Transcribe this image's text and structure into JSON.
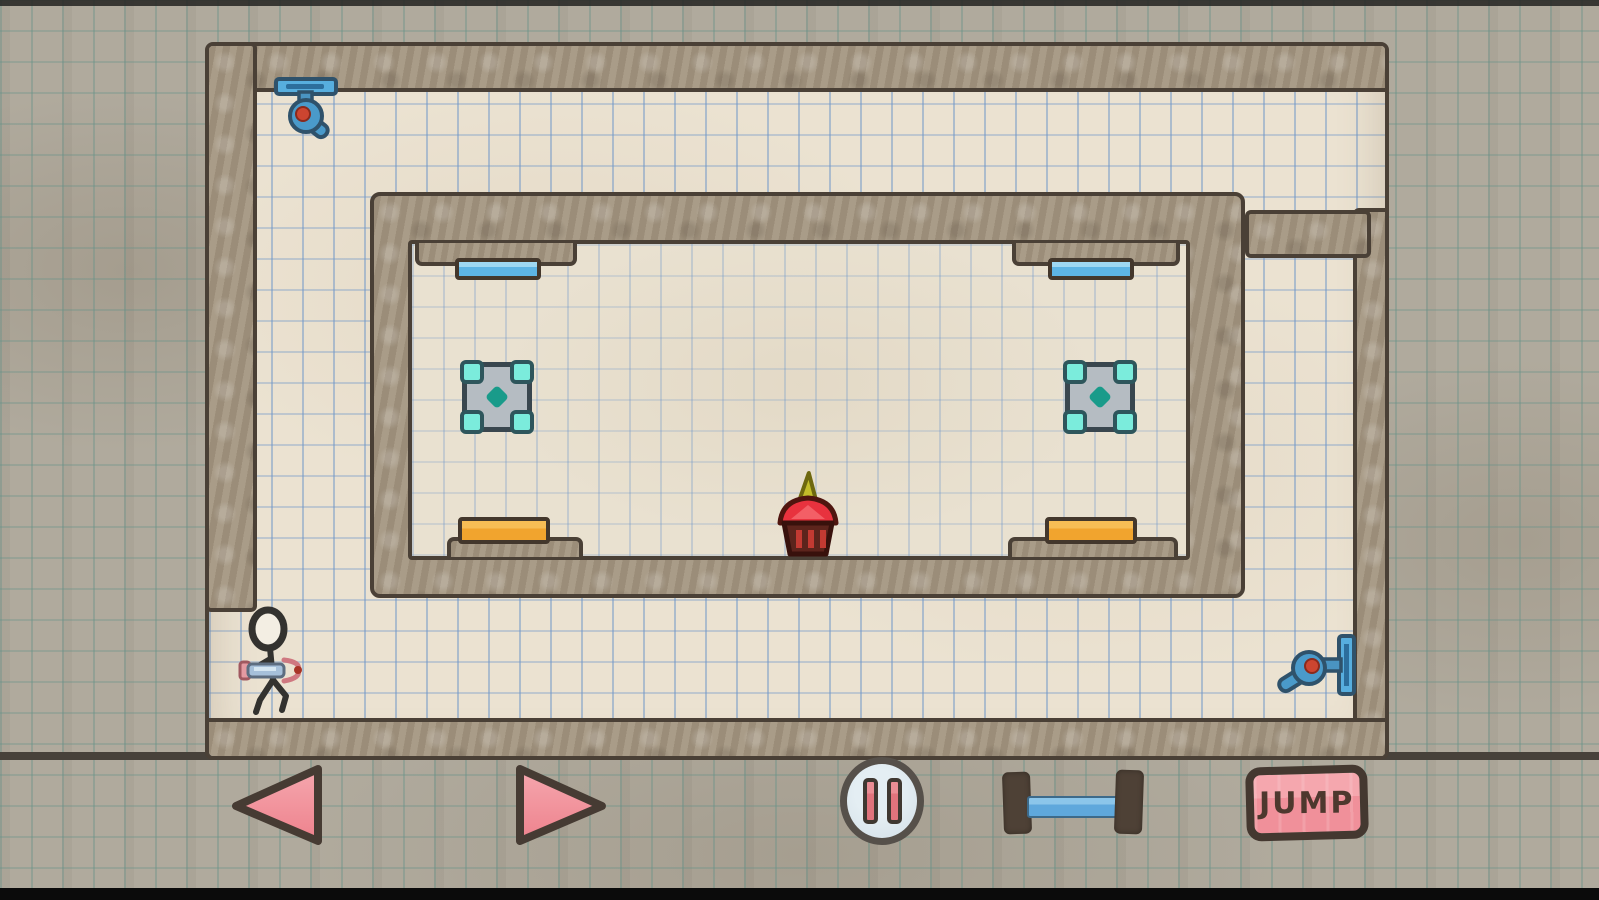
{
  "hud": {
    "move_left": {
      "icon": "left-arrow-icon",
      "fill": "#f2939c"
    },
    "move_right": {
      "icon": "right-arrow-icon",
      "fill": "#f2939c"
    },
    "pause": {
      "icon": "pause-icon",
      "fill": "#d3dfe7",
      "bars": "#e0737c"
    },
    "platform_tool": {
      "icon": "platform-icon",
      "bar": "#5fa8dc",
      "caps": "#4e4136"
    },
    "jump": {
      "label": "JUMP",
      "fill": "#f0909a",
      "text": "#4e382e"
    }
  },
  "level": {
    "player": {
      "icon": "stick-figure-icon",
      "holding": "portal-gun",
      "position": "bottom-left-floor"
    },
    "goal": {
      "icon": "cupcake-icon",
      "position": "center-on-inner-wall"
    },
    "emitters": [
      {
        "icon": "portal-emitter-icon",
        "mount": "ceiling-top-left",
        "dot_color": "#cc4530",
        "rail_color": "#57aede"
      },
      {
        "icon": "portal-emitter-icon",
        "mount": "right-wall",
        "dot_color": "#cc4530",
        "rail_color": "#57aede"
      }
    ],
    "platforms": [
      {
        "type": "blue",
        "color": "#5db4e4",
        "position": "upper-left-ceiling-ledge"
      },
      {
        "type": "blue",
        "color": "#5db4e4",
        "position": "upper-right-ceiling-ledge"
      },
      {
        "type": "orange",
        "color": "#f1a42e",
        "position": "lower-left-floor-ledge"
      },
      {
        "type": "orange",
        "color": "#f1a42e",
        "position": "lower-right-floor-ledge"
      }
    ],
    "pads": [
      {
        "icon": "crystal-pad-icon",
        "gem_color": "#7becdc",
        "position": "mid-left-wall"
      },
      {
        "icon": "crystal-pad-icon",
        "gem_color": "#7becdc",
        "position": "mid-right-wall"
      }
    ]
  },
  "palette": {
    "outer_paper": "#b0aa9d",
    "outer_grid": "#68928a",
    "field_paper": "#ebe2d1",
    "field_grid": "#6e96c8",
    "wall_fill": "#a49681",
    "outline": "#4a4036"
  }
}
